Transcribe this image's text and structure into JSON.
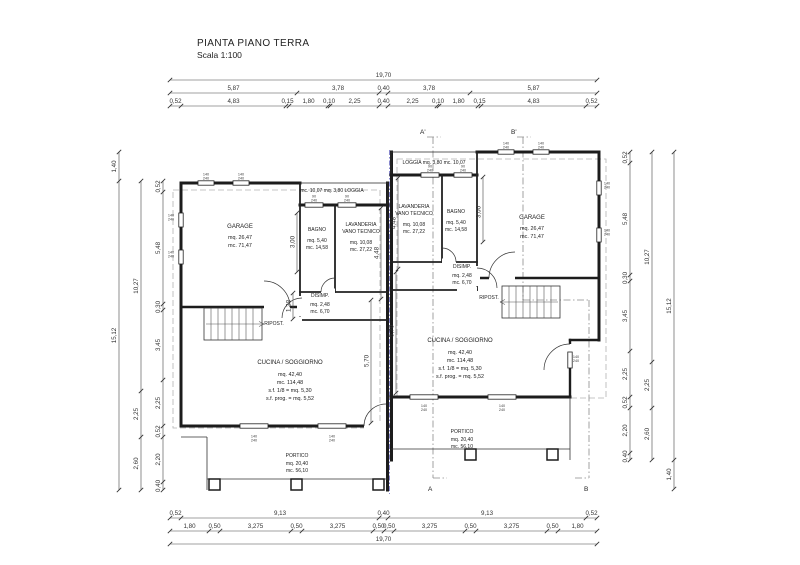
{
  "title": {
    "main": "PIANTA PIANO TERRA",
    "scale": "Scala 1:100"
  },
  "dims": {
    "top_total": "19,70",
    "top_r2": [
      "5,87",
      "3,78",
      "0,40",
      "3,78",
      "5,87"
    ],
    "top_r3": [
      "0,52",
      "4,83",
      "0,15",
      "1,80",
      "0,10",
      "2,25",
      "0,40",
      "2,25",
      "0,10",
      "1,80",
      "0,15",
      "4,83",
      "0,52"
    ],
    "bot_r1": [
      "0,52",
      "9,13",
      "0,40",
      "9,13",
      "0,52"
    ],
    "bot_r2": [
      "1,80",
      "0,50",
      "3,275",
      "0,50",
      "3,275",
      "0,50",
      "0,50",
      "3,275",
      "0,50",
      "3,275",
      "0,50",
      "1,80"
    ],
    "bot_total": "19,70",
    "left_inner": [
      "0,52",
      "5,48",
      "0,30",
      "3,45",
      "2,25",
      "0,52",
      "2,20",
      "0,40"
    ],
    "left_mid": [
      "10,27",
      "2,25",
      "2,60"
    ],
    "left_outer": [
      "1,40",
      "15,12"
    ],
    "right_inner": [
      "0,52",
      "5,48",
      "0,30",
      "3,45",
      "2,25",
      "0,52",
      "2,20",
      "0,40"
    ],
    "right_mid": [
      "10,27",
      "2,25",
      "2,60"
    ],
    "right_outer": [
      "15,12",
      "1,40"
    ],
    "int": {
      "bagno": "3,00",
      "lav": "4,48",
      "disimp": "1,38",
      "sogg": "5,70"
    }
  },
  "rooms": {
    "left": {
      "loggia": "mc. 10,07  mq. 3,80  LOGGIA",
      "garage": {
        "n": "GARAGE",
        "mq": "mq. 26,47",
        "mc": "mc. 71,47"
      },
      "bagno": {
        "n": "BAGNO",
        "mq": "mq. 5,40",
        "mc": "mc. 14,58"
      },
      "lav": {
        "n1": "LAVANDERIA",
        "n2": "VANO TECNICO",
        "mq": "mq. 10,08",
        "mc": "mc. 27,22"
      },
      "disimp": {
        "n": "DISIMP.",
        "mq": "mq. 2,48",
        "mc": "mc. 6,70"
      },
      "ripost": "RIPOST.",
      "cucina": {
        "n": "CUCINA / SOGGIORNO",
        "mq": "mq. 42,40",
        "mc": "mc. 114,48",
        "s1": "s.f. 1/8 = mq. 5,30",
        "s2": "s.f. prog. = mq. 5,52"
      },
      "portico": {
        "n": "PORTICO",
        "mq": "mq. 20,40",
        "mc": "mc. 56,10"
      }
    },
    "right": {
      "loggia": "LOGGIA  mq. 3,80  mc. 10,07",
      "garage": {
        "n": "GARAGE",
        "mq": "mq. 26,47",
        "mc": "mc. 71,47"
      },
      "bagno": {
        "n": "BAGNO",
        "mq": "mq. 5,40",
        "mc": "mc. 14,58"
      },
      "lav": {
        "n1": "LAVANDERIA",
        "n2": "VANO TECNICO",
        "mq": "mq. 10,08",
        "mc": "mc. 27,22"
      },
      "disimp": {
        "n": "DISIMP.",
        "mq": "mq. 2,48",
        "mc": "mc. 6,70"
      },
      "ripost": "RIPOST.",
      "cucina": {
        "n": "CUCINA / SOGGIORNO",
        "mq": "mq. 42,40",
        "mc": "mc. 114,48",
        "s1": "s.f. 1/8 = mq. 5,30",
        "s2": "s.f. prog. = mq. 5,52"
      },
      "portico": {
        "n": "PORTICO",
        "mq": "mq. 20,40",
        "mc": "mc. 56,10"
      }
    }
  },
  "sections": {
    "at": "A'",
    "bt": "B'",
    "ab": "A",
    "bb": "B"
  },
  "tags": {
    "a": "140",
    "b": "240",
    "c": "90"
  }
}
